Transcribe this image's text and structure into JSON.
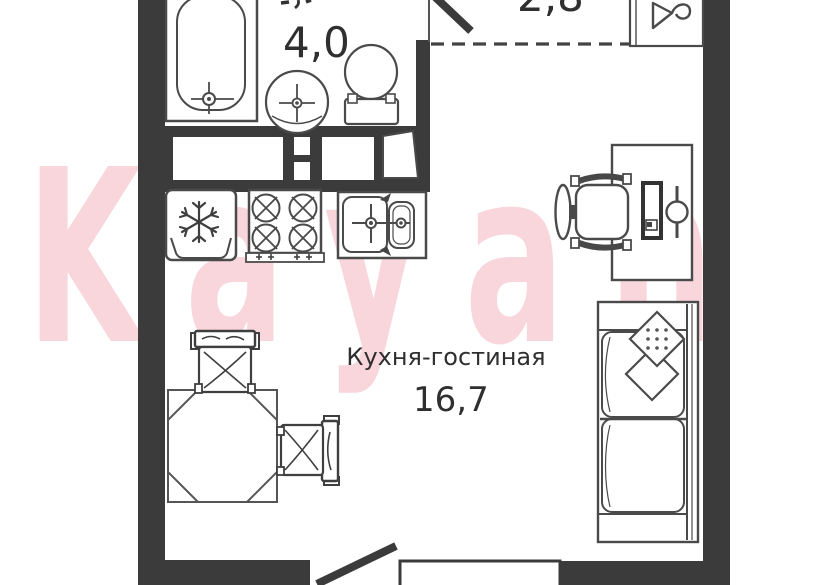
{
  "watermark": {
    "text": "Kayan",
    "color": "#f8d6dc"
  },
  "rooms": {
    "kitchen_living": {
      "label": "Кухня-гостиная",
      "area": "16,7"
    },
    "bathroom": {
      "area": "4,0"
    },
    "hallway": {
      "area": "2,8"
    }
  },
  "colors": {
    "wall": "#3b3b3b",
    "outline": "#4a4a4a",
    "text": "#2f2f2f",
    "background": "#ffffff",
    "watermark_pink": "#f8d6dc"
  },
  "fixtures": [
    "bathtub",
    "washbasin",
    "toilet",
    "fridge",
    "stove",
    "kitchen-sink",
    "dining-table",
    "dining-chair",
    "dining-chair",
    "desk",
    "office-chair",
    "monitor",
    "desk-lamp",
    "sofa",
    "pillow",
    "pillow",
    "entrance-door",
    "balcony-door",
    "window",
    "vent-shaft"
  ]
}
